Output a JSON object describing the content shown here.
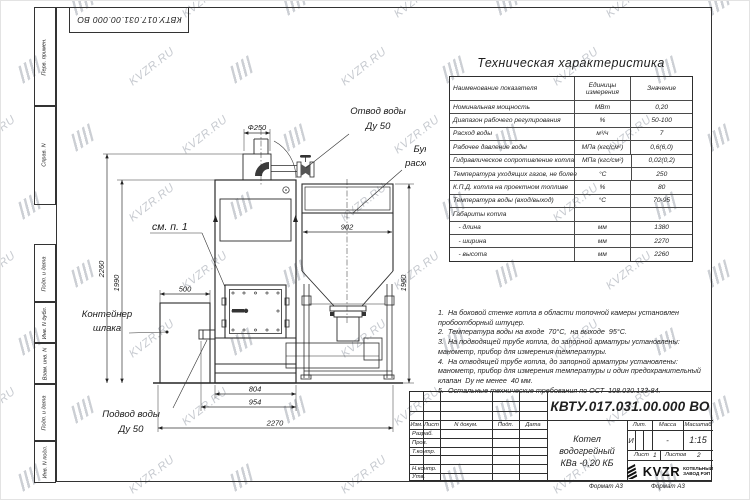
{
  "sheet": {
    "stamp_top_left": "КВТУ.017.031.00.000  ВО",
    "side_labels": [
      "Перв. примен.",
      "Справ. N",
      "Подп. и дата",
      "Инв. N дубл.",
      "Взам. инв. N",
      "Подп. и дата",
      "Инв. N подл."
    ],
    "format_left": "Формат А3",
    "format_right": "Формат А3"
  },
  "watermark": {
    "text": "KVZR.RU",
    "color": "#a2a8b1"
  },
  "tech_table": {
    "title": "Техническая характеристика",
    "headers": [
      "Наименование показателя",
      "Единицы измерения",
      "Значение"
    ],
    "rows": [
      {
        "name": "Номинальная мощность",
        "unit": "МВт",
        "value": "0,20"
      },
      {
        "name": "Диапазон рабочего регулирования",
        "unit": "%",
        "value": "50-100"
      },
      {
        "name": "Расход воды",
        "unit": "м³/ч",
        "value": "7"
      },
      {
        "name": "Рабочее давление воды",
        "unit": "МПа (кгс/см²)",
        "value": "0,6(6,0)"
      },
      {
        "name": "Гидравлическое сопротивление котла",
        "unit": "МПа (кгс/см²)",
        "value": "0,02(0,2)"
      },
      {
        "name": "Температура уходящих газов, не более",
        "unit": "°С",
        "value": "250"
      },
      {
        "name": "К.П.Д. котла на проектном топливе",
        "unit": "%",
        "value": "80"
      },
      {
        "name": "Температура воды (вход/выход)",
        "unit": "°С",
        "value": "70-95"
      },
      {
        "name": "Габариты котла",
        "unit": "",
        "value": ""
      },
      {
        "name": "   - длина",
        "unit": "мм",
        "value": "1380"
      },
      {
        "name": "   - ширина",
        "unit": "мм",
        "value": "2270"
      },
      {
        "name": "   - высота",
        "unit": "мм",
        "value": "2260"
      }
    ]
  },
  "notes": {
    "lines": [
      "1.  На боковой стенке котла в области топочной камеры установлен",
      "пробоотборный штуцер.",
      "2.  Температура воды на входе  70°С,  на выходе  95°С.",
      "3.  На подводящей трубе котла, до запорной арматуры установлены:",
      "манометр, прибор для измерения температуры.",
      "4.  На отводящей трубе котла, до запорной арматуры установлены:",
      "манометр, прибор для измерения температуры и один предохранительный",
      "клапан  Dу не менее  40 мм.",
      "5.  Остальные технические требования по ОСТ  108.030.133-84."
    ]
  },
  "drawing": {
    "labels": {
      "otvod_1": "Отвод воды",
      "otvod_2": "Ду 50",
      "bunker_1": "Бункер",
      "bunker_2": "расходный",
      "container_1": "Контейнер",
      "container_2": "шлака",
      "podvod_1": "Подвод воды",
      "podvod_2": "Ду 50",
      "see_note": "см. п. 1"
    },
    "dims": {
      "phi250": "Ф250",
      "d902": "902",
      "d500": "500",
      "d2260": "2260",
      "d1990": "1990",
      "d1960": "1960",
      "d804": "804",
      "d954": "954",
      "d2270": "2270"
    }
  },
  "title_block": {
    "doc_number": "КВТУ.017.031.00.000  ВО",
    "name_line1": "Котел водогрейный",
    "name_line2": "КВа -0,20  КБ",
    "header_cols": [
      "Изм.",
      "Лист",
      "N докум.",
      "Подп.",
      "Дата"
    ],
    "row_labels": [
      "Разраб.",
      "Пров.",
      "Т.контр.",
      "",
      "Н.контр.",
      "Утв."
    ],
    "lit_label": "Лит.",
    "mass_label": "Масса",
    "scale_label": "Масштаб",
    "lit_value": "И",
    "mass_value": "-",
    "scale_value": "1:15",
    "sheet_label": "Лист",
    "sheet_value": "1",
    "sheets_label": "Листов",
    "sheets_value": "2",
    "company": {
      "logo": "KVZR",
      "line1": "КОТЕЛЬНЫЙ",
      "line2": "ЗАВОД РЭП"
    }
  }
}
